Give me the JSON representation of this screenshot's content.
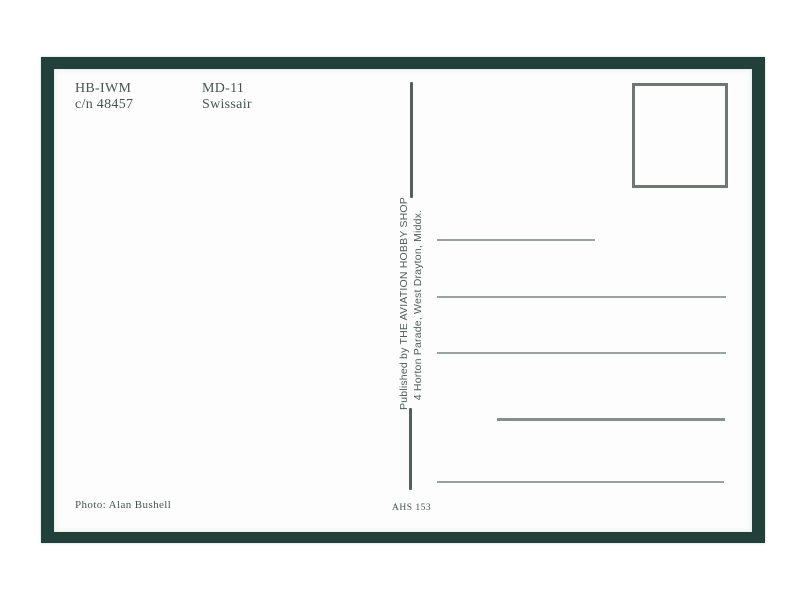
{
  "postcard": {
    "registration": "HB-IWM",
    "construction_number": "c/n 48457",
    "aircraft_type": "MD-11",
    "airline": "Swissair",
    "publisher": {
      "line1": "Published by THE AVIATION HOBBY SHOP",
      "line2": "4 Horton Parade, West Drayton, Middx."
    },
    "photo_credit": "Photo: Alan Bushell",
    "catalog_number": "AHS 153",
    "address_lines_count": 5
  },
  "colors": {
    "page_bg": "#ffffff",
    "border_green": "#21403a",
    "card_white": "#fcfdfc",
    "text_dark": "#4a534f",
    "publisher_text": "#515e59",
    "rule_color": "#555f5a",
    "stamp_border": "#6d7873",
    "line_gray": "#9ba39f",
    "line_dark": "#868f8b"
  }
}
